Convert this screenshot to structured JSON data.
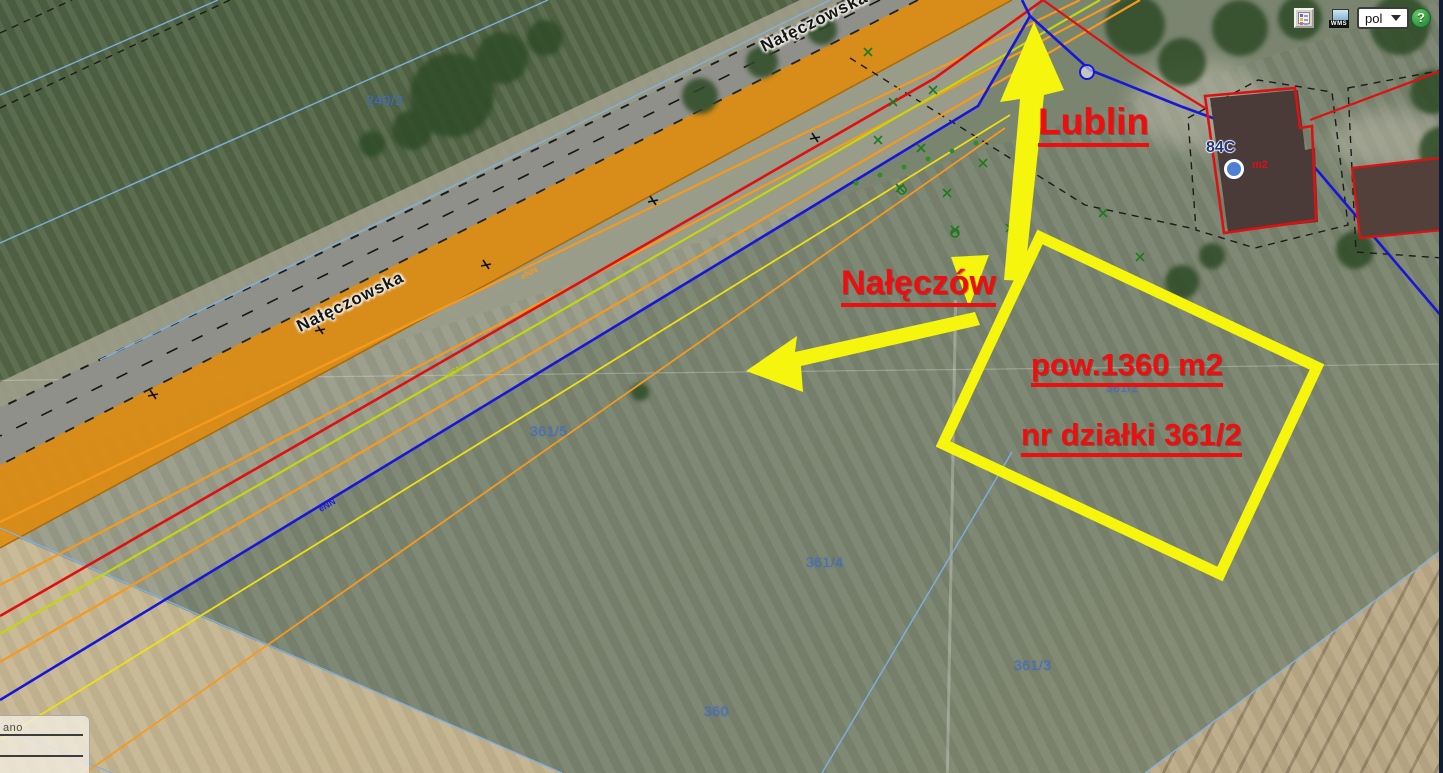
{
  "toolbar": {
    "legend_icon": "legend-icon",
    "wms_icon": "wms-monitor-icon",
    "wms_label": "WMS",
    "language_value": "pol",
    "help_label": "?"
  },
  "map": {
    "street_label": "Nałęczowska",
    "annotations": {
      "city": "Lublin",
      "town": "Nałęczów",
      "area": "pow.1360 m2",
      "parcel": "nr działki 361/2"
    },
    "parcel_labels": [
      "240/2",
      "361/5",
      "361/2",
      "361/4",
      "361/3",
      "360"
    ],
    "address_label": "84C",
    "building_label": "m2",
    "cable_labels": [
      "eNN",
      "eSN",
      "eNN"
    ],
    "colors": {
      "annotation_red": "#ed0f0f",
      "highlight_yellow": "#f6f50e",
      "parcel_blue": "#3e6dd0",
      "road_orange": "#e08d12",
      "line_orange": "#f59a1d",
      "line_red": "#e01010",
      "line_green_yellow": "#c3d60e",
      "line_blue": "#1717d6",
      "cadastral_blue": "#7fb2e5"
    }
  },
  "panel": {
    "partial_text": "ano"
  }
}
